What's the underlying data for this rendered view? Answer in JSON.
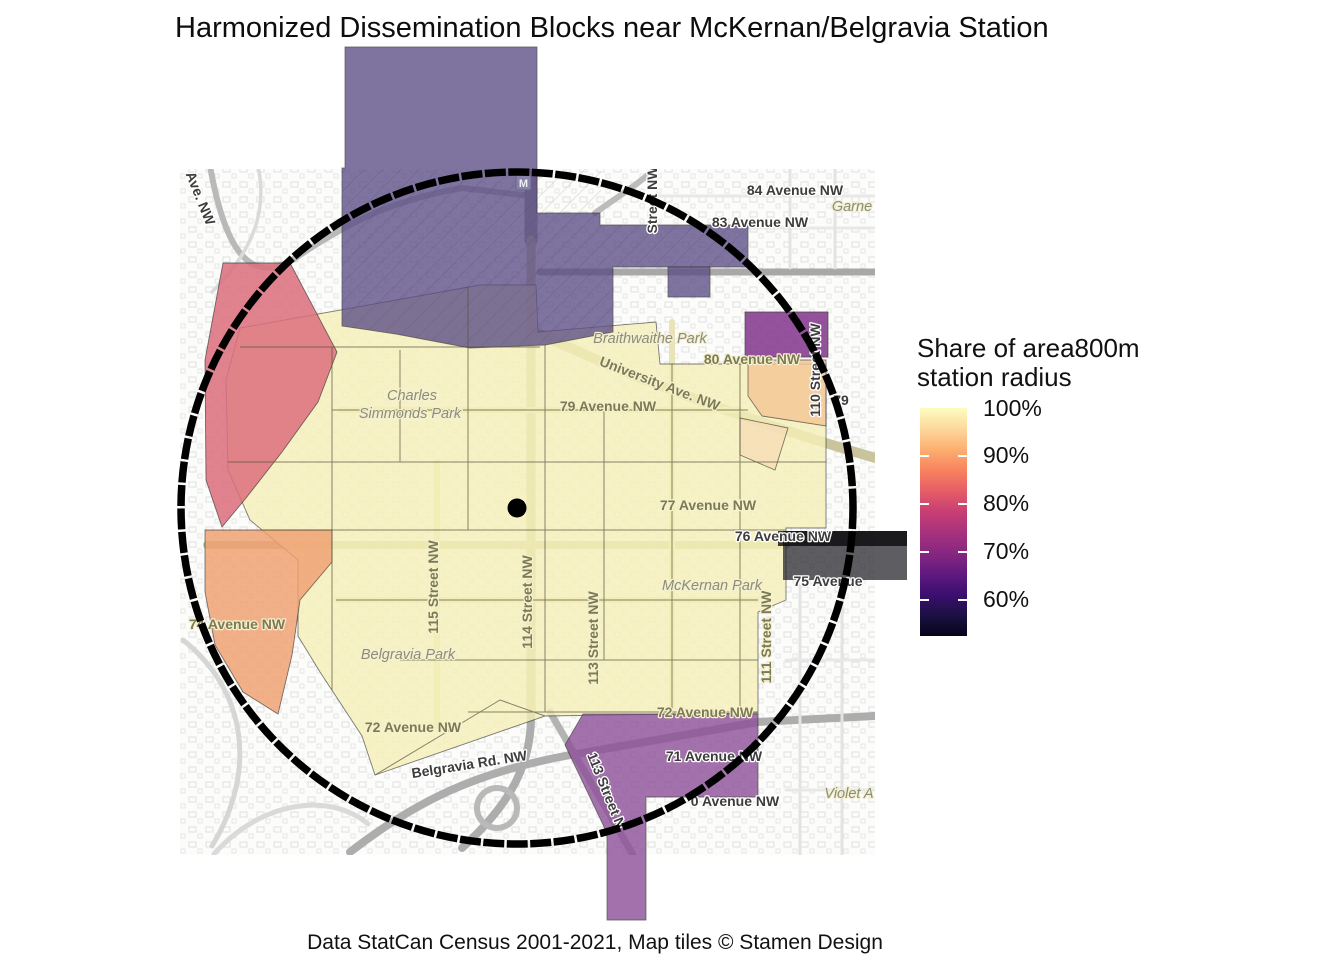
{
  "title": "Harmonized Dissemination Blocks near McKernan/Belgravia Station",
  "caption": "Data StatCan Census 2001-2021, Map tiles © Stamen Design",
  "legend": {
    "title_lines": [
      "Share of area800m",
      "station radius"
    ],
    "ticks": [
      {
        "label": "100%",
        "offset": 1
      },
      {
        "label": "90%",
        "offset": 48
      },
      {
        "label": "80%",
        "offset": 96
      },
      {
        "label": "70%",
        "offset": 144
      },
      {
        "label": "60%",
        "offset": 192
      }
    ],
    "gradient": [
      "#fcfdbf",
      "#fdd89c",
      "#fcaf71",
      "#f8825e",
      "#e65d66",
      "#c83e73",
      "#a8327d",
      "#872781",
      "#611980",
      "#3b0f70",
      "#1c1044",
      "#050418"
    ]
  },
  "map": {
    "station_marker": "M",
    "labels": [
      {
        "t": "Ave. NW",
        "x": 196,
        "y": 200,
        "r": 68,
        "c": "rd"
      },
      {
        "t": "84 Avenue NW",
        "x": 795,
        "y": 195,
        "r": 0,
        "c": "rd"
      },
      {
        "t": "Garne",
        "x": 852,
        "y": 211,
        "r": 0,
        "c": "pk"
      },
      {
        "t": "83 Avenue NW",
        "x": 760,
        "y": 227,
        "r": 0,
        "c": "rd"
      },
      {
        "t": "Street NW",
        "x": 657,
        "y": 200,
        "r": -90,
        "c": "rd"
      },
      {
        "t": "110 Street NW",
        "x": 820,
        "y": 370,
        "r": -90,
        "c": "rd"
      },
      {
        "t": "80 Avenue NW",
        "x": 752,
        "y": 364,
        "r": 0,
        "c": "ro"
      },
      {
        "t": "Braithwaithe Park",
        "x": 650,
        "y": 343,
        "r": 0,
        "c": "pk"
      },
      {
        "t": "University Ave. NW",
        "x": 658,
        "y": 388,
        "r": 21,
        "c": "ro"
      },
      {
        "t": "79 Avenue NW",
        "x": 608,
        "y": 411,
        "r": 0,
        "c": "ro"
      },
      {
        "t": "79",
        "x": 841,
        "y": 405,
        "r": 0,
        "c": "rd"
      },
      {
        "t": "Charles",
        "x": 412,
        "y": 400,
        "r": 0,
        "c": "pk"
      },
      {
        "t": "Simmonds Park",
        "x": 410,
        "y": 418,
        "r": 0,
        "c": "pk"
      },
      {
        "t": "77 Avenue NW",
        "x": 708,
        "y": 510,
        "r": 0,
        "c": "ro"
      },
      {
        "t": "76 Avenue NW",
        "x": 783,
        "y": 541,
        "r": 0,
        "c": "rd"
      },
      {
        "t": "75 Avenue",
        "x": 828,
        "y": 586,
        "r": 0,
        "c": "rd"
      },
      {
        "t": "115 Street NW",
        "x": 438,
        "y": 587,
        "r": -90,
        "c": "ro"
      },
      {
        "t": "114 Street NW",
        "x": 532,
        "y": 602,
        "r": -90,
        "c": "ro"
      },
      {
        "t": "113 Street NW",
        "x": 598,
        "y": 638,
        "r": -90,
        "c": "ro"
      },
      {
        "t": "111 Street NW",
        "x": 771,
        "y": 637,
        "r": -90,
        "c": "ro"
      },
      {
        "t": "McKernan Park",
        "x": 712,
        "y": 590,
        "r": 0,
        "c": "pk"
      },
      {
        "t": "74 Avenue NW",
        "x": 237,
        "y": 629,
        "r": 0,
        "c": "ro"
      },
      {
        "t": "Belgravia Park",
        "x": 408,
        "y": 659,
        "r": 0,
        "c": "pk"
      },
      {
        "t": "72 Avenue NW",
        "x": 413,
        "y": 732,
        "r": 0,
        "c": "ro"
      },
      {
        "t": "72 Avenue NW",
        "x": 705,
        "y": 717,
        "r": 0,
        "c": "ro"
      },
      {
        "t": "71 Avenue NW",
        "x": 714,
        "y": 761,
        "r": 0,
        "c": "rd"
      },
      {
        "t": "0 Avenue NW",
        "x": 735,
        "y": 806,
        "r": 0,
        "c": "rd"
      },
      {
        "t": "Violet A",
        "x": 849,
        "y": 798,
        "r": 0,
        "c": "pk"
      },
      {
        "t": "Belgravia Rd. NW",
        "x": 470,
        "y": 769,
        "r": -9,
        "c": "rd"
      },
      {
        "t": "113 Street N",
        "x": 602,
        "y": 792,
        "r": 68,
        "c": "rd"
      }
    ]
  },
  "blocks": [
    {
      "name": "university-campus-block",
      "fill": "#5c4d86"
    },
    {
      "name": "block-83-avenue-extension",
      "fill": "#5c4d86"
    },
    {
      "name": "block-110-street-purple",
      "fill": "#83358c"
    },
    {
      "name": "block-80-avenue-orange",
      "fill": "#f5c695"
    },
    {
      "name": "block-79-avenue-pale-wedge",
      "fill": "#f8ddb7"
    },
    {
      "name": "west-pink-block",
      "fill": "#dd6f7d"
    },
    {
      "name": "west-orange-block",
      "fill": "#f0a071"
    },
    {
      "name": "core-yellow-blocks",
      "fill": "#f6f0b8"
    },
    {
      "name": "south-purple-block",
      "fill": "#8d5099"
    },
    {
      "name": "east-dark-block",
      "fill": "#202025"
    }
  ],
  "radius_circle": {
    "center_x": 517,
    "center_y": 508,
    "radius": 336
  }
}
